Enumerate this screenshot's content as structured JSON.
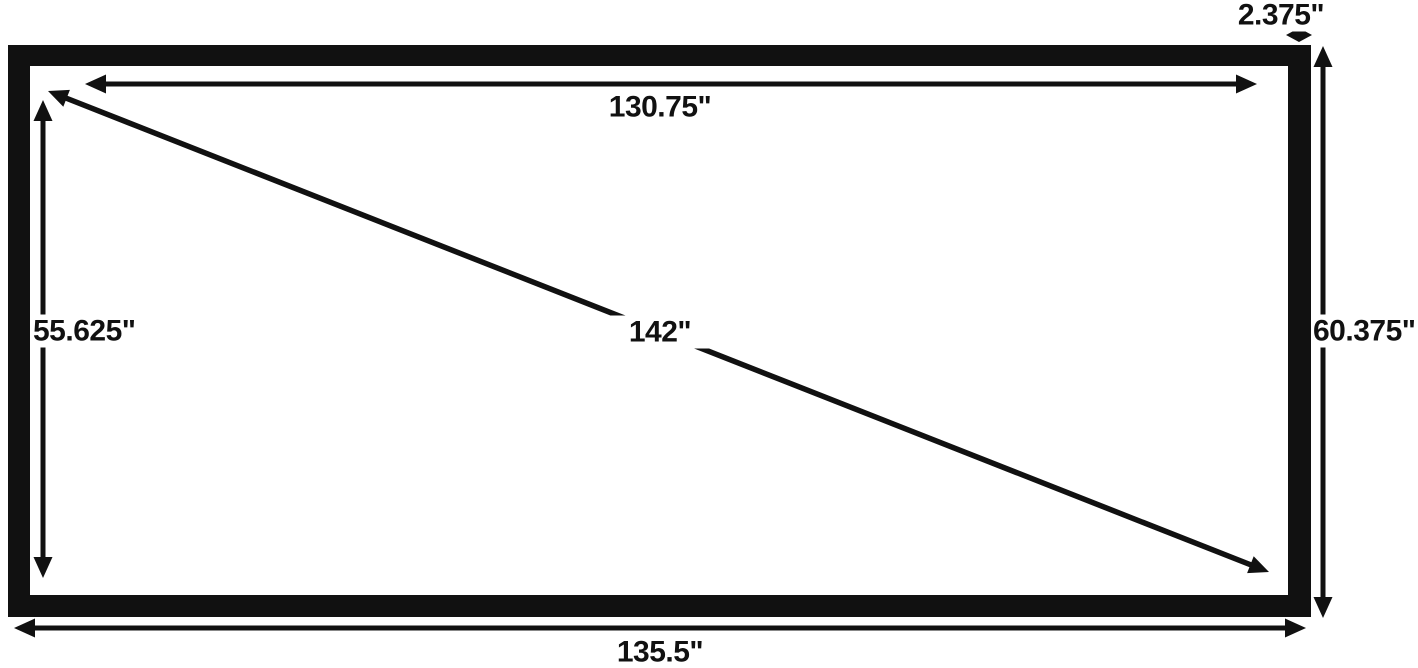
{
  "diagram": {
    "ink_color": "#111111",
    "background_color": "#ffffff",
    "measurements": {
      "inner_width": "130.75\"",
      "inner_height": "55.625\"",
      "diagonal": "142\"",
      "outer_height": "60.375\"",
      "outer_width": "135.5\"",
      "frame_border_width": "2.375\""
    }
  }
}
